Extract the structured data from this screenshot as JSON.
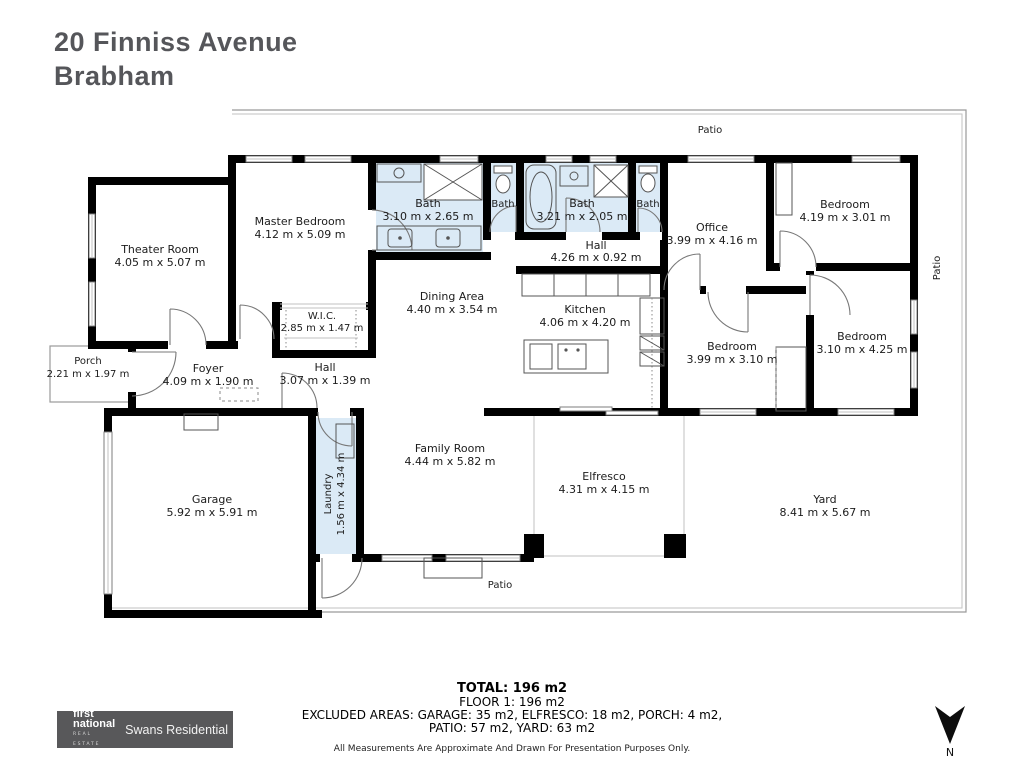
{
  "title": {
    "line1": "20 Finniss Avenue",
    "line2": "Brabham"
  },
  "rooms": {
    "theater": {
      "name": "Theater Room",
      "dims": "4.05 m x 5.07 m"
    },
    "master": {
      "name": "Master Bedroom",
      "dims": "4.12 m x 5.09 m"
    },
    "wic": {
      "name": "W.I.C.",
      "dims": "2.85 m x 1.47 m"
    },
    "bath_ensuite": {
      "name": "Bath",
      "dims": "3.10 m x 2.65 m"
    },
    "bath_left": {
      "name": "Bath"
    },
    "bath_main": {
      "name": "Bath",
      "dims": "3.21 m x 2.05 m"
    },
    "bath_right": {
      "name": "Bath"
    },
    "hall_top": {
      "name": "Hall",
      "dims": "4.26 m x 0.92 m"
    },
    "office": {
      "name": "Office",
      "dims": "3.99 m x 4.16 m"
    },
    "bedroom_top_right": {
      "name": "Bedroom",
      "dims": "4.19 m x 3.01 m"
    },
    "bedroom_right": {
      "name": "Bedroom",
      "dims": "3.10 m x 4.25 m"
    },
    "bedroom_center": {
      "name": "Bedroom",
      "dims": "3.99 m x 3.10 m"
    },
    "dining": {
      "name": "Dining Area",
      "dims": "4.40 m x 3.54 m"
    },
    "kitchen": {
      "name": "Kitchen",
      "dims": "4.06 m x 4.20 m"
    },
    "family": {
      "name": "Family Room",
      "dims": "4.44 m x 5.82 m"
    },
    "foyer": {
      "name": "Foyer",
      "dims": "4.09 m x 1.90 m"
    },
    "hall_left": {
      "name": "Hall",
      "dims": "3.07 m x 1.39 m"
    },
    "porch": {
      "name": "Porch",
      "dims": "2.21 m x 1.97 m"
    },
    "garage": {
      "name": "Garage",
      "dims": "5.92 m x 5.91 m"
    },
    "laundry": {
      "name": "Laundry",
      "dims": "1.56 m x 4.34 m"
    },
    "elfresco": {
      "name": "Elfresco",
      "dims": "4.31 m x 4.15 m"
    },
    "yard": {
      "name": "Yard",
      "dims": "8.41 m x 5.67 m"
    },
    "patio_top": {
      "name": "Patio"
    },
    "patio_right": {
      "name": "Patio"
    },
    "patio_bottom": {
      "name": "Patio"
    }
  },
  "footer": {
    "total": "TOTAL: 196 m2",
    "floor": "FLOOR 1: 196 m2",
    "excluded_line1": "EXCLUDED AREAS: GARAGE: 35 m2, ELFRESCO: 18 m2, PORCH: 4 m2,",
    "excluded_line2": "PATIO: 57 m2, YARD: 63 m2",
    "disclaimer": "All Measurements Are Approximate And Drawn For Presentation Purposes Only."
  },
  "logo": {
    "brand_top": "first",
    "brand_bottom": "national",
    "brand_tagline": "REAL ESTATE",
    "agency": "Swans Residential"
  },
  "compass": {
    "north_label": "N"
  },
  "colors": {
    "wall": "#000000",
    "wet_area_fill": "#dbeaf6",
    "title_text": "#55565a",
    "logo_background": "#58585a",
    "thin_line": "#9a9a9a"
  }
}
